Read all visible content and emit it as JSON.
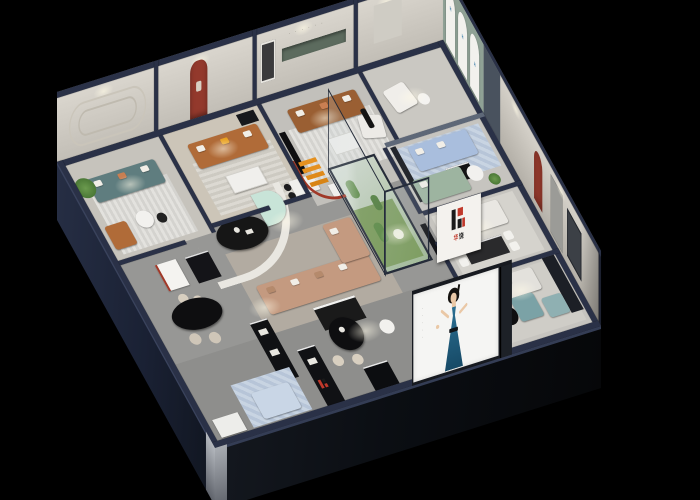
{
  "scene": {
    "description": "isometric cutaway render of a furniture showroom at night",
    "background": "#000000"
  },
  "brand": {
    "logo_mark": "H",
    "logo_char1": "华",
    "logo_char2": "饶",
    "logo_red": "#c0392b",
    "logo_black": "#141414",
    "logo_blue": "#3a7ca8"
  },
  "poster": {
    "figure": "woman-in-teal-dress",
    "dress_color": "#1f5c7d",
    "side_marks": "· · · · ·"
  },
  "wall_decor": {
    "slogan_marks": "· · · · · ·"
  },
  "palette": {
    "exterior_navy": "#222a40",
    "wall_top_navy": "#2a3147",
    "interior_wall": "#d8d4cc",
    "sage_wall": "#8fa195",
    "slate_partition": "#49525e",
    "floor_gray": "#979795",
    "accent_red_arch": "#93392c",
    "accent_orange": "#e89020",
    "leather_caramel": "#b06b38",
    "sofa_tan": "#c49a80",
    "sofa_teal": "#5f7d7f",
    "sofa_mint": "#c8e4d8",
    "sofa_blue": "#a9bedd",
    "sofa_sage": "#9db4a0",
    "seat_teal_blue": "#7ba2a6",
    "plant_green": "#4d7c3a",
    "cactus_green": "#5d8a46"
  }
}
